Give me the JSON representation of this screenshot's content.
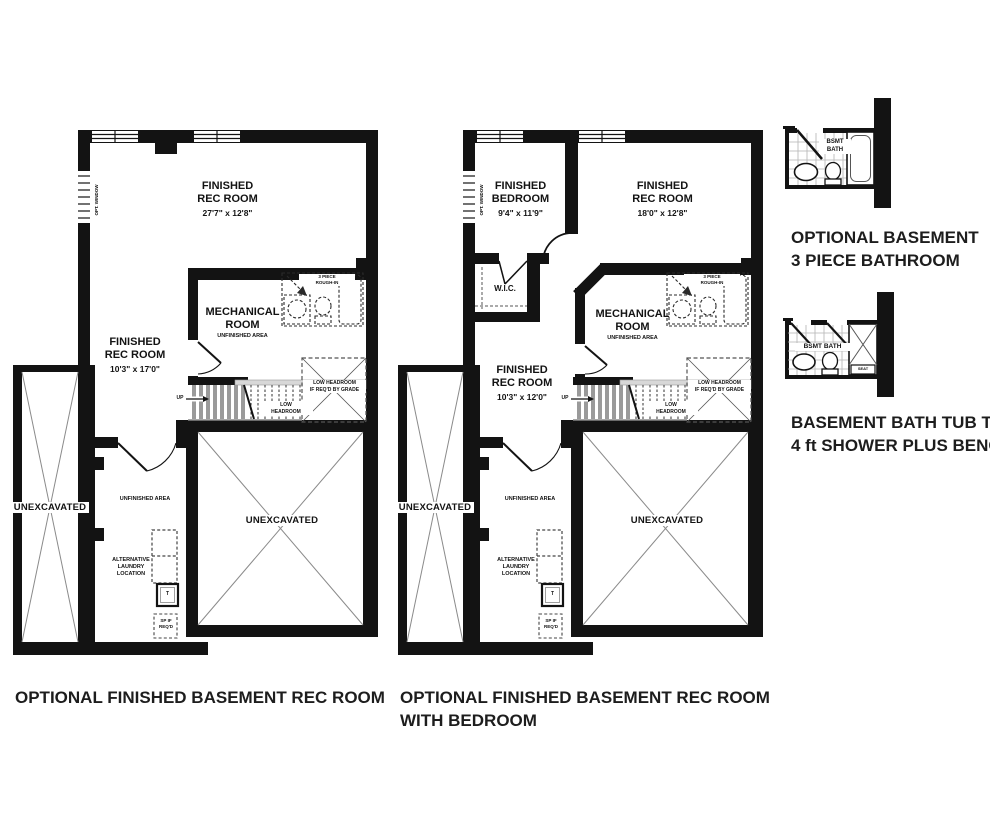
{
  "palette": {
    "ink": "#131313",
    "thin_line": "#8a8a8a",
    "tread": "#9a9a9a",
    "tile": "#b3b3b3",
    "caption_ink": "#1d1d1d",
    "background": "#ffffff"
  },
  "plan1": {
    "caption": "OPTIONAL FINISHED BASEMENT REC ROOM",
    "opt_window": "OPT. WINDOW",
    "rec_main": {
      "l1": "FINISHED",
      "l2": "REC ROOM",
      "dims": "27'7\" x 12'8\""
    },
    "rec_side": {
      "l1": "FINISHED",
      "l2": "REC ROOM",
      "dims": "10'3\" x 17'0\""
    },
    "mech": {
      "l1": "MECHANICAL",
      "l2": "ROOM",
      "sub": "UNFINISHED AREA"
    },
    "rough": {
      "l1": "3 PIECE",
      "l2": "ROUGH-IN"
    },
    "up": "UP",
    "low": {
      "l1": "LOW",
      "l2": "HEADROOM"
    },
    "grade": {
      "l1": "LOW HEADROOM",
      "l2": "IF REQ'D BY GRADE"
    },
    "unexcavated_side": "UNEXCAVATED",
    "unexcavated_main": "UNEXCAVATED",
    "unfinished": "UNFINISHED AREA",
    "laundry": {
      "l1": "ALTERNATIVE",
      "l2": "LAUNDRY",
      "l3": "LOCATION"
    },
    "tank": "T",
    "sump": {
      "l1": "SP IF",
      "l2": "REQ'D"
    }
  },
  "plan2": {
    "caption_1": "OPTIONAL FINISHED BASEMENT REC ROOM",
    "caption_2": "WITH BEDROOM",
    "opt_window": "OPT. WINDOW",
    "bedroom": {
      "l1": "FINISHED",
      "l2": "BEDROOM",
      "dims": "9'4\" x 11'9\""
    },
    "rec_main": {
      "l1": "FINISHED",
      "l2": "REC ROOM",
      "dims": "18'0\" x 12'8\""
    },
    "rec_side": {
      "l1": "FINISHED",
      "l2": "REC ROOM",
      "dims": "10'3\" x 12'0\""
    },
    "wic": "W.I.C.",
    "mech": {
      "l1": "MECHANICAL",
      "l2": "ROOM",
      "sub": "UNFINISHED AREA"
    },
    "rough": {
      "l1": "3 PIECE",
      "l2": "ROUGH-IN"
    },
    "up": "UP",
    "low": {
      "l1": "LOW",
      "l2": "HEADROOM"
    },
    "grade": {
      "l1": "LOW HEADROOM",
      "l2": "IF REQ'D BY GRADE"
    },
    "unexcavated_side": "UNEXCAVATED",
    "unexcavated_main": "UNEXCAVATED",
    "unfinished": "UNFINISHED AREA",
    "laundry": {
      "l1": "ALTERNATIVE",
      "l2": "LAUNDRY",
      "l3": "LOCATION"
    },
    "tank": "T",
    "sump": {
      "l1": "SP IF",
      "l2": "REQ'D"
    }
  },
  "bath_detail": {
    "label_1": "BSMT",
    "label_2": "BATH",
    "caption_1": "OPTIONAL BASEMENT",
    "caption_2": "3 PIECE BATHROOM"
  },
  "shower_detail": {
    "label": "BSMT BATH",
    "seat": "SEAT",
    "caption_1": "BASEMENT BATH TUB TO",
    "caption_2": "4 ft SHOWER PLUS BENCH"
  }
}
